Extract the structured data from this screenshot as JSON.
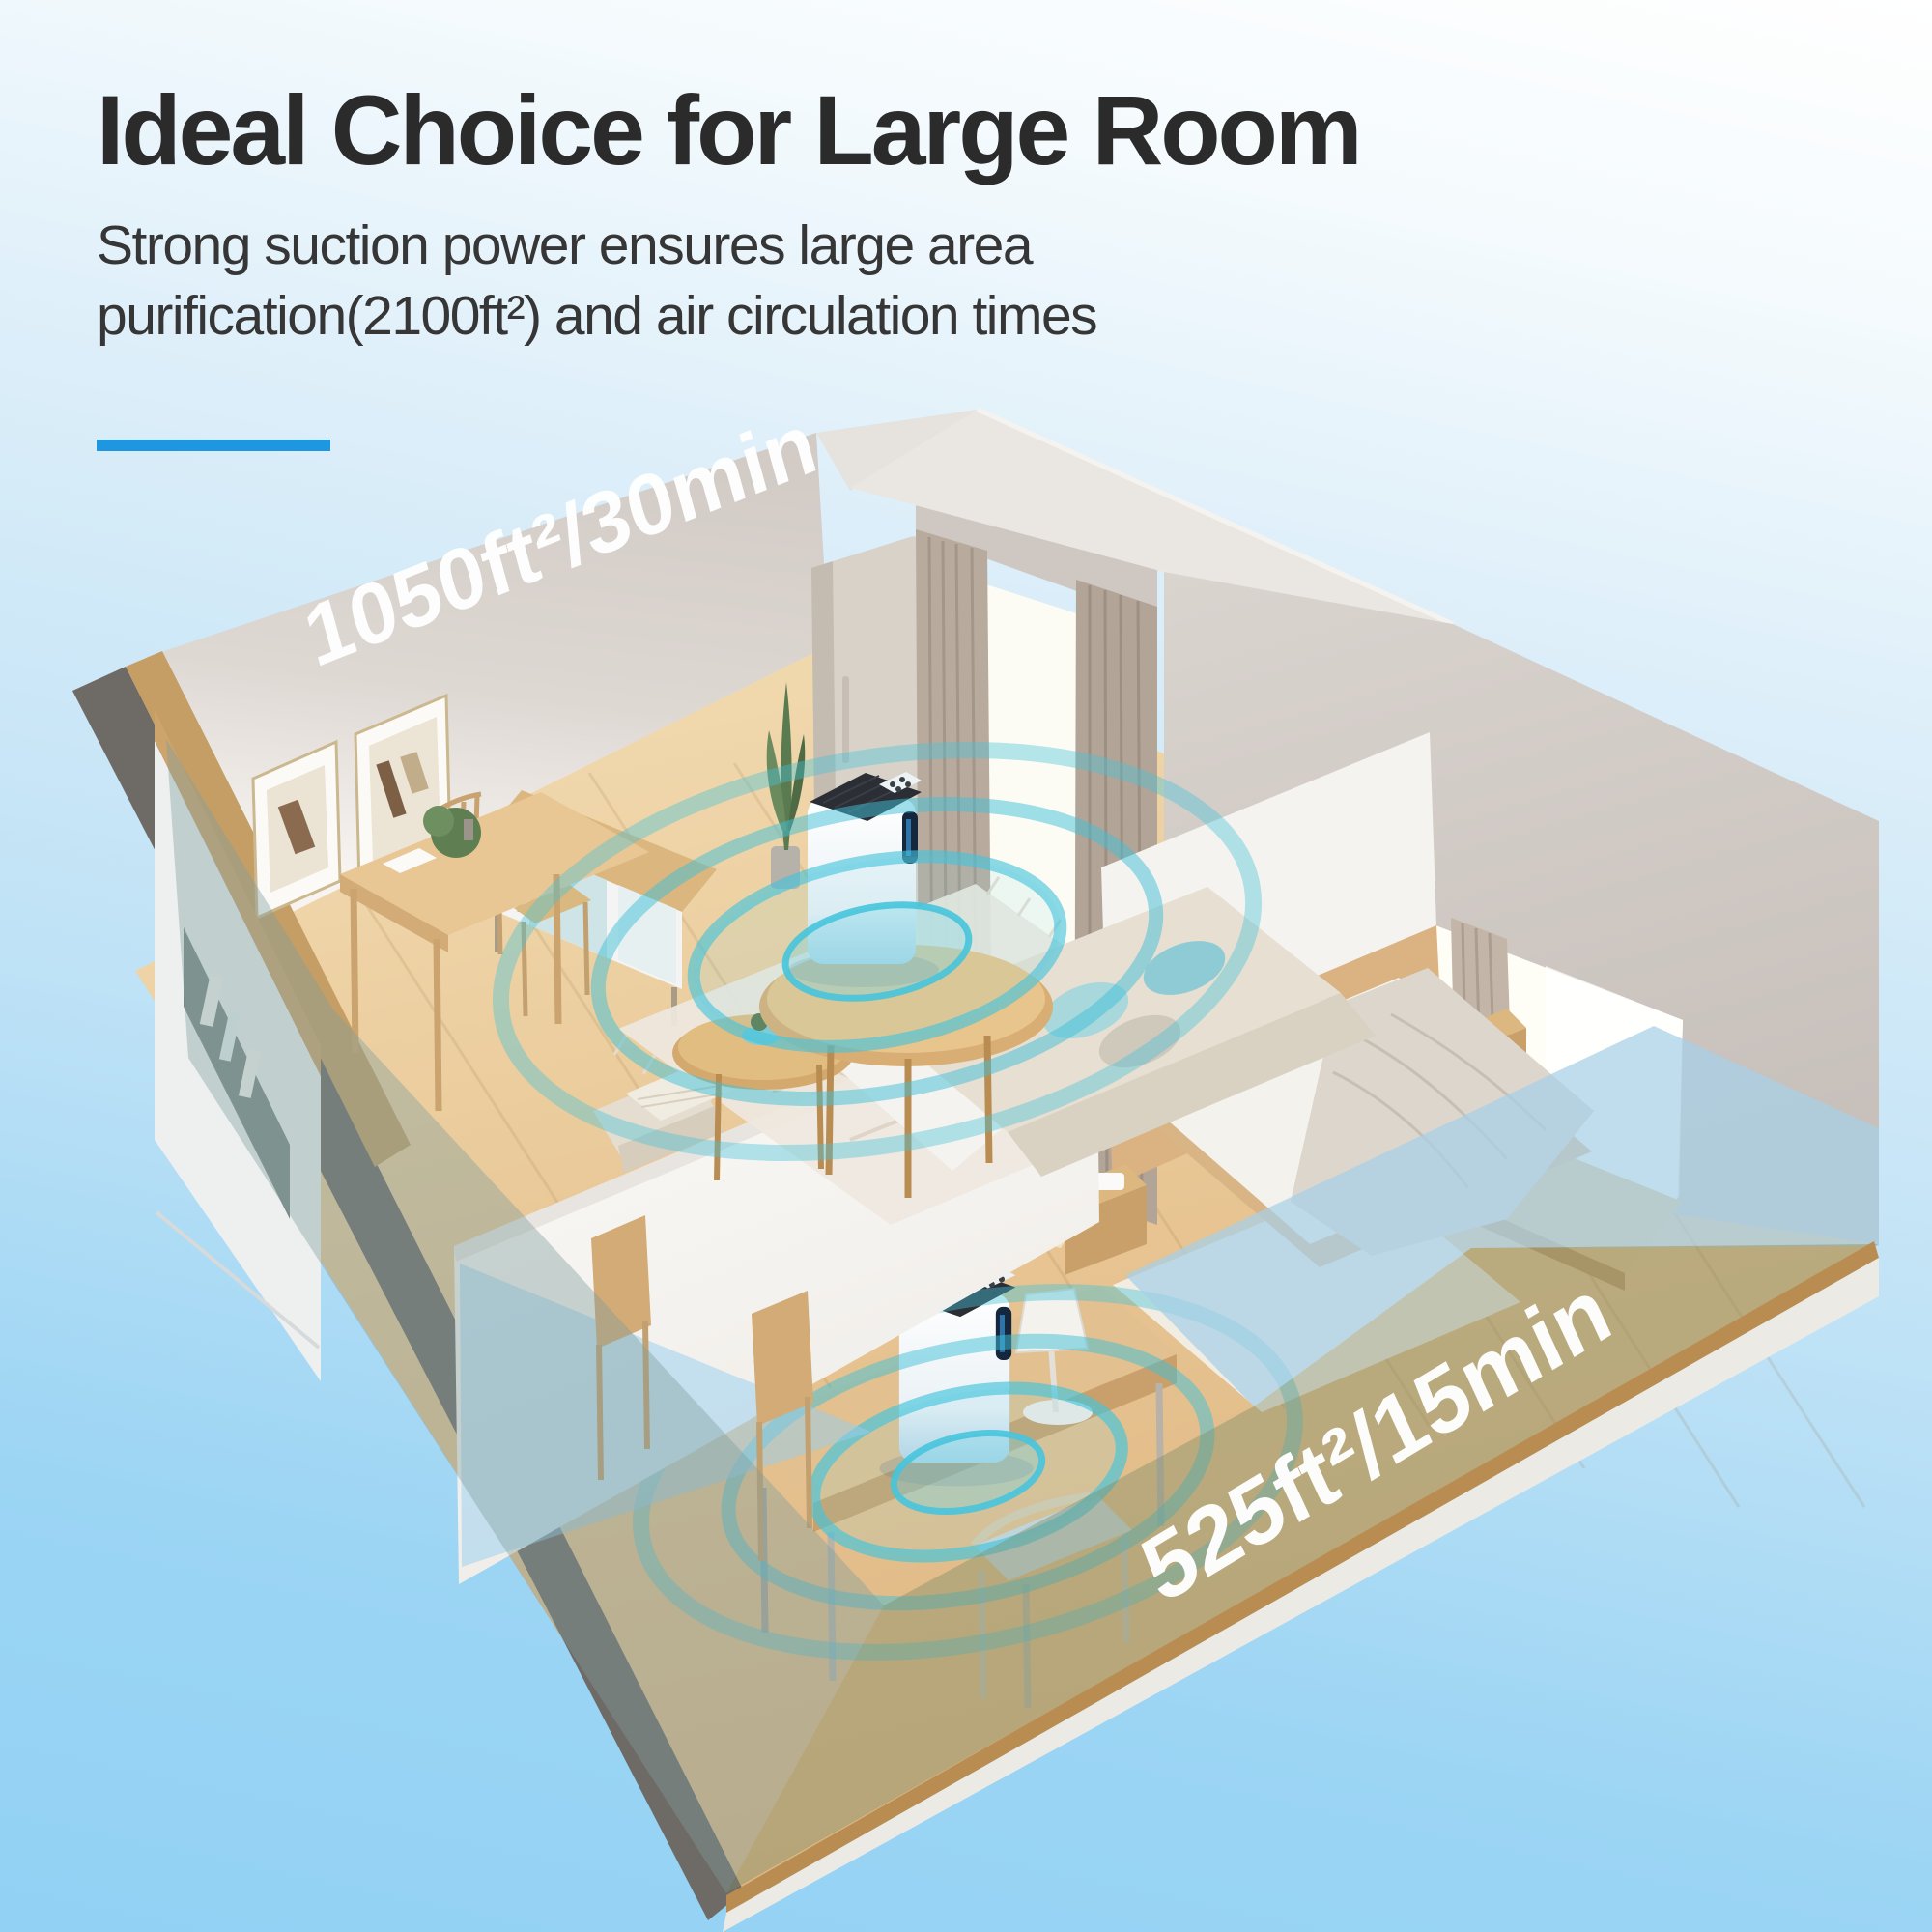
{
  "header": {
    "title": "Ideal Choice for Large Room",
    "subtitle_line1": "Strong suction power ensures large area",
    "subtitle_line2": "purification(2100ft²) and air circulation times",
    "accent_color": "#1e96e0"
  },
  "scene": {
    "living_room_coverage_label": "1050ft²/30min",
    "bedroom_coverage_label": "525ft²/15min",
    "total_coverage": "2100ft²",
    "colors": {
      "background_top": "#ffffff",
      "background_bottom": "#92d1f4",
      "accent_blue": "#1e96e0",
      "ripple_teal": "#3fc2da",
      "wall_greige": "#d3ccc7",
      "floor_wood": "#e7c492"
    }
  }
}
